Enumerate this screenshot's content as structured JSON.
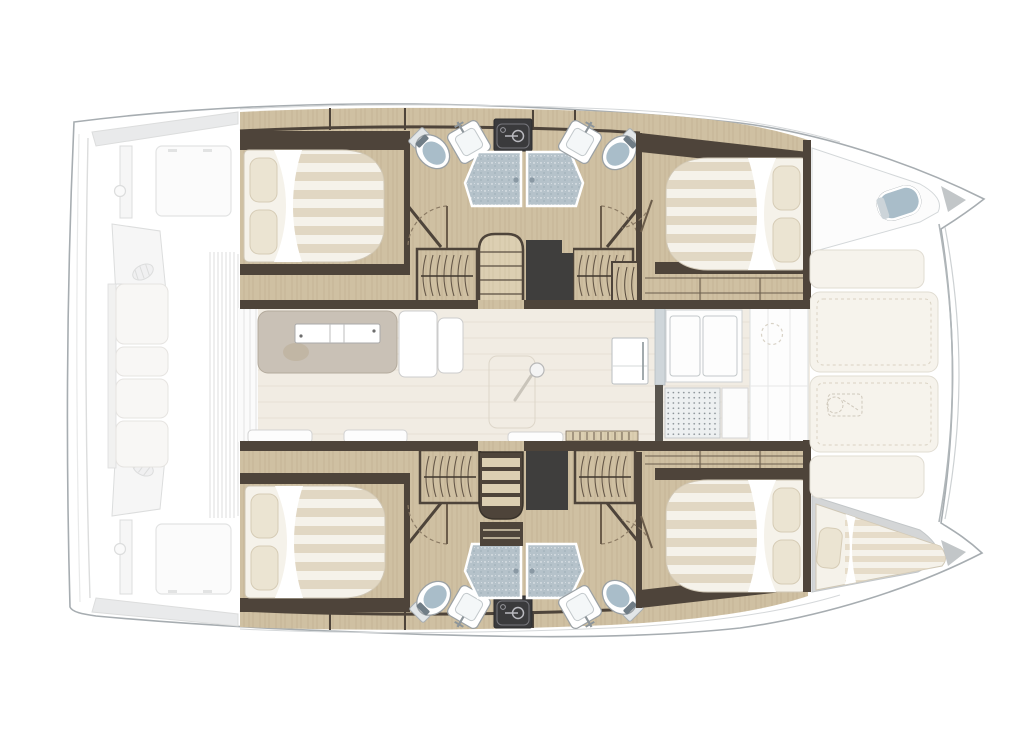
{
  "palette": {
    "hull_outline": "#a7adb1",
    "ghost_line": "#dcdddd",
    "ghost_fill": "#f6f6f6",
    "ghost_fill_dark": "#e9eaeb",
    "deck_white": "#fdfdfd",
    "wall_dark": "#4e443a",
    "wall_darker": "#3a332b",
    "wood": "#cfc0a2",
    "wood_light": "#dccfb2",
    "wood_grain": "#a08a68",
    "void_dark": "#3f3e3d",
    "equip_box": "#3a3a3c",
    "equip_line": "#b9b9bf",
    "bed_sheet": "#f5f2ea",
    "bed_stripe": "#ddd3bd",
    "pillow": "#ebe4d2",
    "pillow_edge": "#d6ccb6",
    "fixture_line": "#9aa0a4",
    "porcelain_blue": "#a9bdc9",
    "shower_fill": "#b5c2ca",
    "salon_floor": "#f1ece3",
    "salon_plank": "#e3dcd0",
    "sofa_fill": "#c9c1b6",
    "sofa_line": "#b3aa9c",
    "door_arc": "#8b7a64",
    "mat_fill": "#edf0f1",
    "mat_dot": "#878f94",
    "pad_fill": "#f6f3ec",
    "pad_stitch": "#d9d2c2",
    "fore_gray": "#d4d6d7",
    "gray_wedge": "#c2c6c8",
    "berth_stripe": "#e3d9c3"
  },
  "floorplan": {
    "type": "catamaran-interior-layout-plan",
    "orientation": "bow-right",
    "aft_deck": {
      "style": "ghosted",
      "elements": [
        "transom-platform",
        "coachroof-edge-upper",
        "coachroof-edge-lower",
        "cockpit-table-upper",
        "cockpit-table-lower",
        "helm-seat-upper",
        "helm-seat-lower",
        "cockpit-bench",
        "deck-grating"
      ]
    },
    "salon": {
      "elements": [
        "sliding-door",
        "lounge-sofa",
        "coffee-table",
        "l-settee",
        "table-pedestal",
        "bench-seat",
        "bench-seat",
        "bench-seat",
        "sideboard-shelf",
        "sideboard-shelf",
        "fridge",
        "galley-counter",
        "galley-sink-unit",
        "floor-grate",
        "forward-lounge",
        "deck-hatch"
      ]
    },
    "upper_hull": {
      "aft_cabin": [
        "double-bed",
        "pillow",
        "pillow"
      ],
      "head": [
        "toilet",
        "washbasin",
        "shower-stall",
        "shower-stall",
        "washbasin",
        "toilet",
        "water-heater"
      ],
      "companionway": [
        "stairs",
        "storage-void",
        "hanging-locker",
        "hanging-locker"
      ],
      "forward_cabin": [
        "double-bed",
        "pillow",
        "pillow",
        "hanging-locker"
      ],
      "forepeak": [
        "crew-toilet"
      ]
    },
    "lower_hull": {
      "aft_cabin": [
        "double-bed",
        "pillow",
        "pillow"
      ],
      "head": [
        "toilet",
        "washbasin",
        "shower-stall",
        "shower-stall",
        "washbasin",
        "toilet",
        "water-heater"
      ],
      "companionway": [
        "stairs",
        "storage-void",
        "shelf-unit",
        "hanging-locker",
        "hanging-locker"
      ],
      "forward_cabin": [
        "double-bed",
        "pillow",
        "pillow"
      ],
      "forepeak": [
        "crew-berth",
        "pillow"
      ]
    },
    "foredeck": {
      "elements": [
        "sunpad",
        "sunpad",
        "sunpad",
        "sunpad",
        "windlass",
        "crossbeam",
        "bow-wedge",
        "bow-wedge"
      ]
    }
  }
}
